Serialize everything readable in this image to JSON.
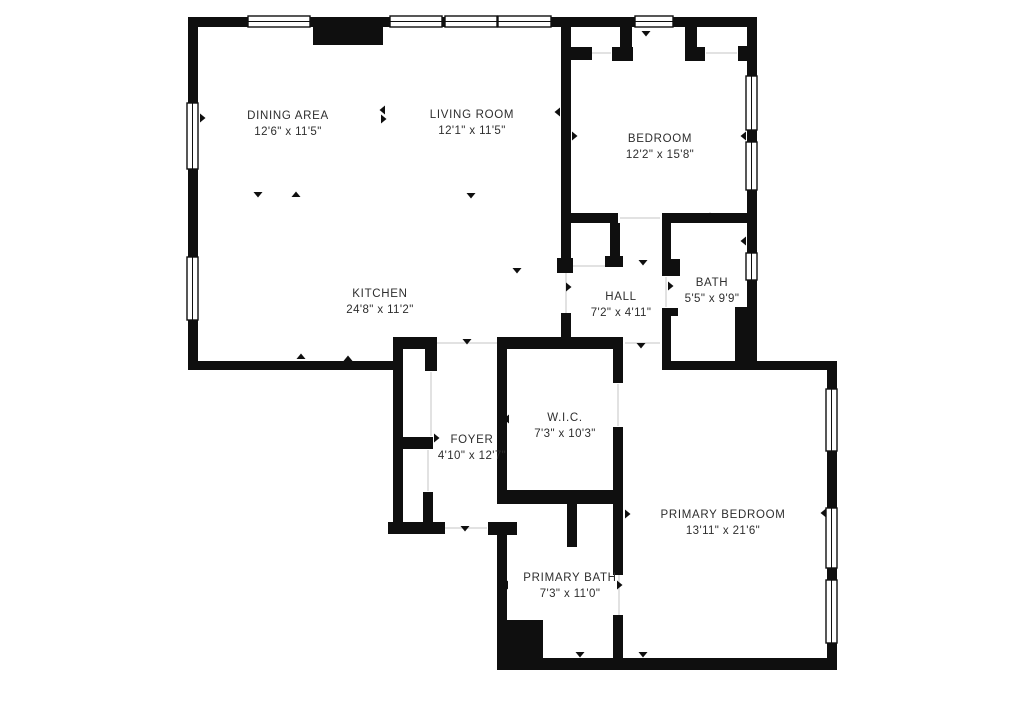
{
  "plan": {
    "type": "floor-plan",
    "colors": {
      "wall": "#0f0f0f",
      "background": "#ffffff",
      "label_text": "#2e2e2e",
      "opening_line": "#d8d8d8"
    },
    "rooms": [
      {
        "id": "dining-area",
        "name": "DINING AREA",
        "dimensions": "12'6\" x 11'5\""
      },
      {
        "id": "living-room",
        "name": "LIVING ROOM",
        "dimensions": "12'1\" x 11'5\""
      },
      {
        "id": "bedroom",
        "name": "BEDROOM",
        "dimensions": "12'2\" x 15'8\""
      },
      {
        "id": "kitchen",
        "name": "KITCHEN",
        "dimensions": "24'8\" x 11'2\""
      },
      {
        "id": "hall",
        "name": "HALL",
        "dimensions": "7'2\" x 4'11\""
      },
      {
        "id": "bath",
        "name": "BATH",
        "dimensions": "5'5\" x 9'9\""
      },
      {
        "id": "wic",
        "name": "W.I.C.",
        "dimensions": "7'3\" x 10'3\""
      },
      {
        "id": "foyer",
        "name": "FOYER",
        "dimensions": "4'10\" x 12'7\""
      },
      {
        "id": "primary-bedroom",
        "name": "PRIMARY BEDROOM",
        "dimensions": "13'11\" x 21'6\""
      },
      {
        "id": "primary-bath",
        "name": "PRIMARY BATH",
        "dimensions": "7'3\" x 11'0\""
      }
    ]
  }
}
